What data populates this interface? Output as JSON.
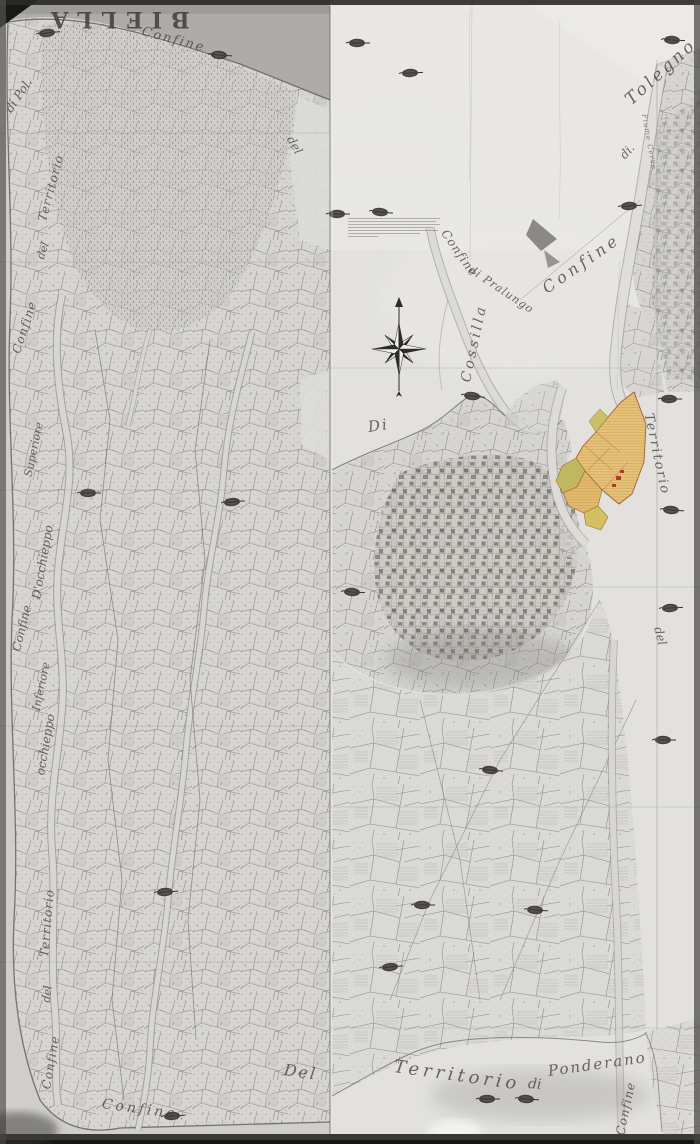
{
  "labels": {
    "biella": "BIELLA",
    "confine_nw": "Confine",
    "del_nw": "del",
    "tolegno": "Tolegno",
    "di_tolegno": "di.",
    "fiume_cervo": "Fiume Cervo",
    "confine_ne": "Confine",
    "confine_pralungo": "Confine",
    "di_pralungo": "di Pralungo",
    "cossilla": "Cossilla",
    "di_cossilla": "Di",
    "territorio_e": "Territorio",
    "del_e": "del",
    "di_pollone": "di Pol.",
    "territorio_w1": "Territorio",
    "del_w1": "del",
    "confine_w1": "Confine",
    "superiore": "Superiore",
    "docchieppo": "D'occhieppo",
    "confine_w2": "Confine",
    "inferiore": "Inferiore",
    "occhieppo": "occhieppo",
    "territorio_w2": "Territorio",
    "del_w2": "del",
    "confine_w3": "Confine",
    "confine_sw": "Confine",
    "del_s": "Del",
    "territorio_s": "Territorio",
    "di_s": "di",
    "ponderano": "Ponderano",
    "confine_se": "Confine"
  },
  "icons": {
    "compass": "compass-rose-icon",
    "stamp": "archive-stamp-icon"
  },
  "colors": {
    "paper_left": "#cfcecb",
    "paper_right": "#e2e1de",
    "highlight_orange": "#e6c478",
    "highlight_green": "#c2b660",
    "highlight_red": "#ab3d24",
    "ink": "#4a463f"
  }
}
